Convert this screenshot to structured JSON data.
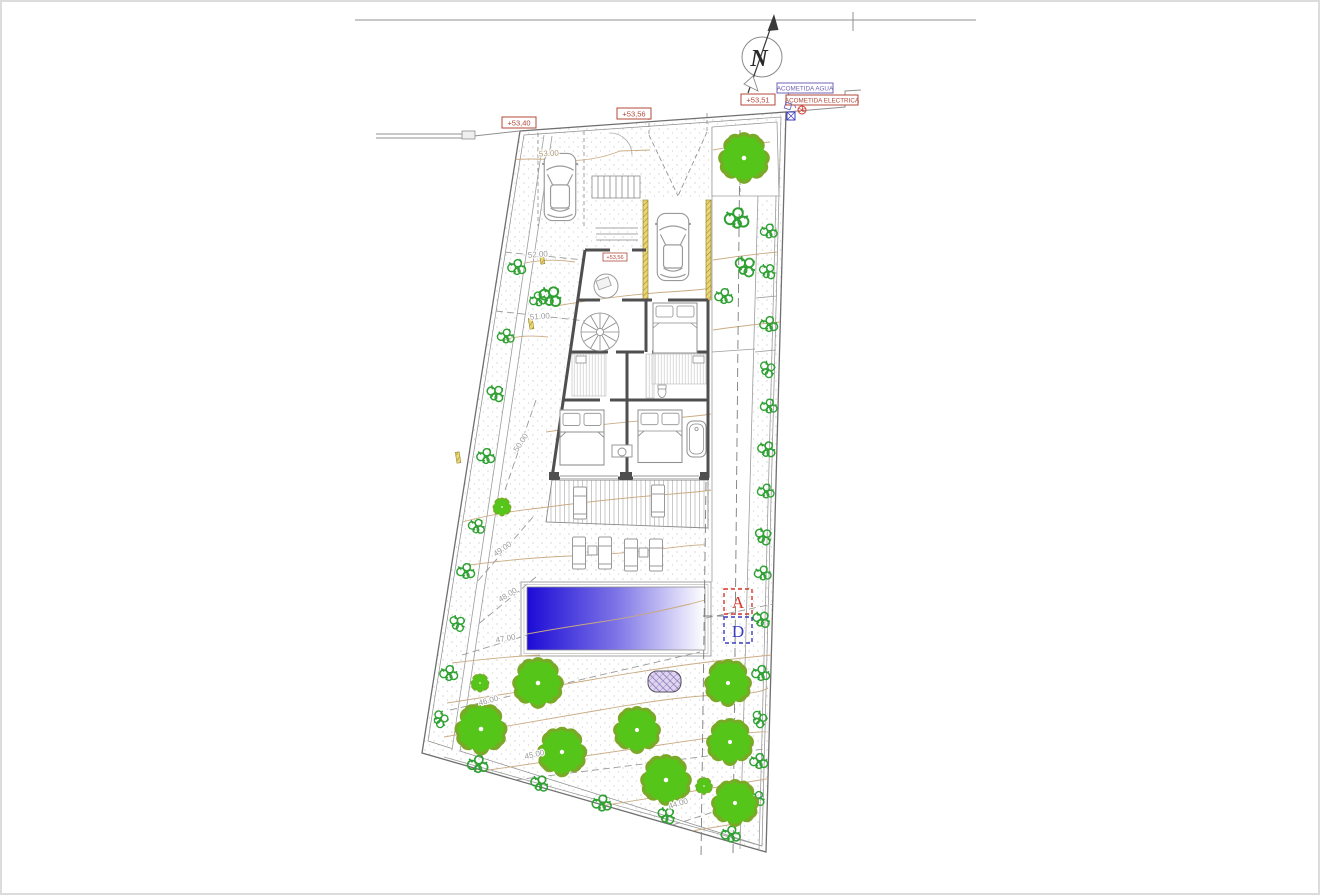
{
  "drawing": {
    "north_label": "N",
    "levels": {
      "street_left": "+53,40",
      "street_center": "+53,56",
      "street_right": "+53,51",
      "entry": "+53,56"
    },
    "utilities": {
      "water": "ACOMETIDA AGUA",
      "electric": "ACOMETIDA ELECTRICA"
    },
    "section_marks": {
      "top": "A",
      "bottom": "D"
    },
    "contour_labels": [
      "53.00",
      "52.00",
      "51.00",
      "50.00",
      "49.00",
      "48.00",
      "47.00",
      "46.00",
      "45.00",
      "44.00"
    ],
    "colors": {
      "tree": "#56c519",
      "bush": "#2fa133",
      "pool_deep": "#1c0bd6",
      "pool_shallow": "#ffffff",
      "level_red": "#b0483a",
      "utility_blue": "#6f63b8",
      "section_a_red": "#d9372a",
      "section_d_blue": "#3b3bc0",
      "terrain": "#c9a87e",
      "walls": "#4f4f4f"
    }
  }
}
